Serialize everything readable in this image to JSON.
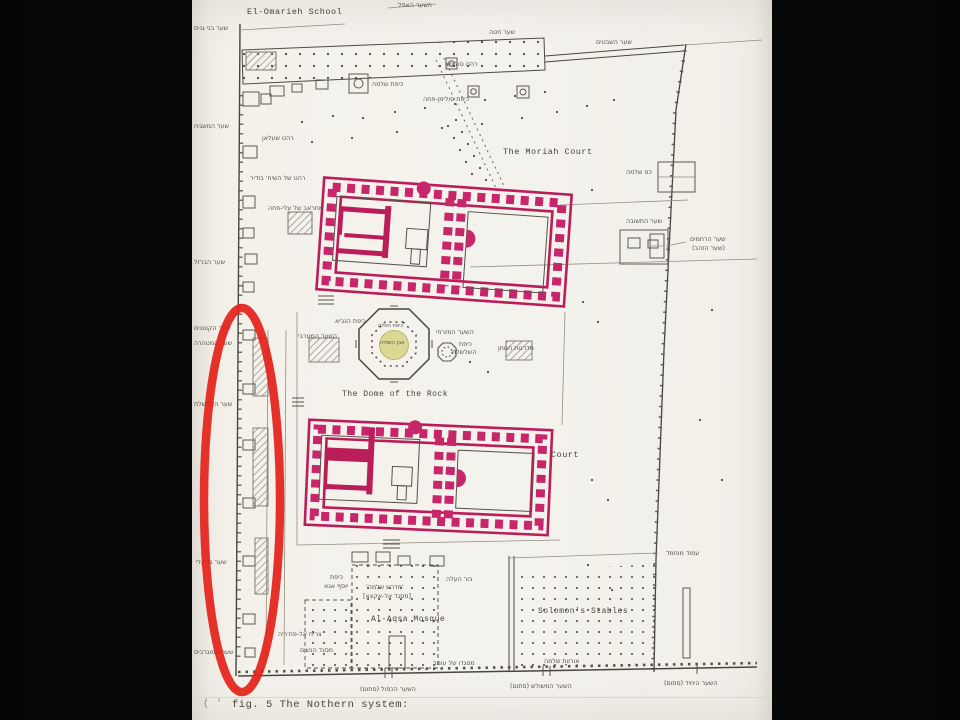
{
  "slide": {
    "background": "#050505",
    "paper_color": "#f3f1ea"
  },
  "colors": {
    "highlight_pink": "#bb1d5a",
    "highlight_pink2": "#c8266a",
    "annotation_red": "#e52119",
    "highlight_yellow": "#d9d78f",
    "ink": "#4a463e"
  },
  "map": {
    "title_note": "scanned archaeological plan of the Temple Mount",
    "annotations": {
      "red_ellipse": {
        "cx": 242,
        "cy": 500,
        "rx": 38,
        "ry": 192,
        "meaning": "hand-drawn red oval over western wall corridor"
      },
      "pink_structures": [
        "northern colonnaded compound",
        "southern colonnaded compound"
      ],
      "yellow_marker": "foundation stone inside Dome of the Rock"
    },
    "labels": [
      {
        "id": "el-omarieh-school",
        "text": "El-Omarieh School",
        "x": 247,
        "y": 8,
        "size": 8.5,
        "font": "mono"
      },
      {
        "id": "moriah-court",
        "text": "The Moriah Court",
        "x": 503,
        "y": 148,
        "size": 8.5,
        "font": "mono"
      },
      {
        "id": "dome-of-the-rock",
        "text": "The Dome of the Rock",
        "x": 342,
        "y": 391,
        "size": 8,
        "font": "mono"
      },
      {
        "id": "court",
        "text": "Court",
        "x": 551,
        "y": 451,
        "size": 8.5,
        "font": "mono"
      },
      {
        "id": "al-aqsa-mosque",
        "text": "Al-Aqsa Mosque",
        "x": 371,
        "y": 616,
        "size": 8,
        "font": "mono"
      },
      {
        "id": "solomons-stables",
        "text": "Solomon's Stables",
        "x": 538,
        "y": 608,
        "size": 8,
        "font": "mono"
      },
      {
        "id": "figure-caption",
        "text": "fig. 5  The Nothern system:",
        "x": 232,
        "y": 700,
        "size": 10.5,
        "font": "mono",
        "color": "#4a473f"
      },
      {
        "id": "caption-mark",
        "text": "( '",
        "x": 203,
        "y": 700,
        "size": 10,
        "font": "mono",
        "color": "#8a857a"
      },
      {
        "id": "gate-haafel",
        "text": "השער האפל",
        "x": 398,
        "y": 3
      },
      {
        "id": "gate-hitta",
        "text": "שער חטה",
        "x": 489,
        "y": 30
      },
      {
        "id": "gate-hashvatim",
        "text": "שער השבטים",
        "x": 596,
        "y": 40
      },
      {
        "id": "kes-shlomo",
        "text": "כס שלמה",
        "x": 626,
        "y": 170
      },
      {
        "id": "gate-hateshuva",
        "text": "שער התשובה",
        "x": 626,
        "y": 219
      },
      {
        "id": "gate-harahamim",
        "text": "שער הרחמים",
        "x": 690,
        "y": 237
      },
      {
        "id": "gate-hazahav",
        "text": "(שער הזהב)",
        "x": 692,
        "y": 246
      },
      {
        "id": "amud-muhammad",
        "text": "עמוד מוחמד",
        "x": 666,
        "y": 551
      },
      {
        "id": "gate-bnei-ganim",
        "text": "שער בני גנים",
        "x": 194,
        "y": 26
      },
      {
        "id": "gate-hamashgiah",
        "text": "שער המשגיח",
        "x": 194,
        "y": 124
      },
      {
        "id": "sabil-shalan",
        "text": "רהט שעלאן",
        "x": 262,
        "y": 136
      },
      {
        "id": "sabil-budeir",
        "text": "רהט של השיח' בודיר",
        "x": 250,
        "y": 176
      },
      {
        "id": "mihrab-ali-pasha",
        "text": "מחראב של עלי-פחה",
        "x": 268,
        "y": 206
      },
      {
        "id": "gate-habarzel",
        "text": "שער הברזל",
        "x": 194,
        "y": 260
      },
      {
        "id": "gate-hakotnim",
        "text": "שער הקוטנים",
        "x": 194,
        "y": 326
      },
      {
        "id": "gate-hamethara",
        "text": "שער המטהרה",
        "x": 194,
        "y": 341
      },
      {
        "id": "gate-hashalshelet",
        "text": "שער השלשלת",
        "x": 194,
        "y": 402
      },
      {
        "id": "gate-barkley",
        "text": "שער ברקלי",
        "x": 196,
        "y": 560
      },
      {
        "id": "gate-hamugrabim",
        "text": "שער המוגרבים",
        "x": 194,
        "y": 650
      },
      {
        "id": "kipat-shlomo",
        "text": "כיפת שלמה",
        "x": 372,
        "y": 82
      },
      {
        "id": "sabil-suleiman",
        "text": "רהט סולימן",
        "x": 447,
        "y": 62
      },
      {
        "id": "kipat-suleiman-pasha",
        "text": "כיפת סולימן-פחה",
        "x": 423,
        "y": 97
      },
      {
        "id": "kipat-hanavi",
        "text": "כיפת הנביא",
        "x": 335,
        "y": 319
      },
      {
        "id": "west-gate-label",
        "text": "השער המערבי",
        "x": 298,
        "y": 334
      },
      {
        "id": "east-gate-label",
        "text": "השער המזרחי",
        "x": 436,
        "y": 330
      },
      {
        "id": "kipat-hashalshelet-1",
        "text": "כיפת",
        "x": 459,
        "y": 342
      },
      {
        "id": "kipat-hashalshelet-2",
        "text": "השלשלת",
        "x": 452,
        "y": 350
      },
      {
        "id": "kipat-hasela",
        "text": "כיפת הסלע",
        "x": 378,
        "y": 324,
        "size": 5.2
      },
      {
        "id": "even-hashtiya",
        "text": "אבן השתיה",
        "x": 380,
        "y": 341,
        "size": 5.2
      },
      {
        "id": "madregot",
        "text": "מדרגות הנוחן",
        "x": 498,
        "y": 346
      },
      {
        "id": "bor-label",
        "text": "בור העלה",
        "x": 446,
        "y": 577
      },
      {
        "id": "midrash-shlomo",
        "text": "'מדרש שלמה'",
        "x": 366,
        "y": 585
      },
      {
        "id": "misgad-alaqsa-he",
        "text": "[מסגד אל-אקצא]",
        "x": 363,
        "y": 594
      },
      {
        "id": "kipat-yusuf-aga-1",
        "text": "כיפת",
        "x": 330,
        "y": 575
      },
      {
        "id": "kipat-yusuf-aga-2",
        "text": "יוסף אגא",
        "x": 324,
        "y": 584
      },
      {
        "id": "minaret-fakhriya",
        "text": "צריח אל-פח'ריה",
        "x": 278,
        "y": 632
      },
      {
        "id": "misgad-hanashim",
        "text": "מסגד הנשים",
        "x": 300,
        "y": 648
      },
      {
        "id": "misgad-omar",
        "text": "מסגדו של עומר",
        "x": 433,
        "y": 661
      },
      {
        "id": "urvot-shlomo",
        "text": "אורוות שלמה",
        "x": 544,
        "y": 659
      },
      {
        "id": "gate-double",
        "text": "השער הכפול (סתום)",
        "x": 360,
        "y": 687
      },
      {
        "id": "gate-triple",
        "text": "השער המשולש (סתום)",
        "x": 510,
        "y": 684
      },
      {
        "id": "gate-single",
        "text": "השער היחיד (סתום)",
        "x": 664,
        "y": 681
      }
    ]
  }
}
